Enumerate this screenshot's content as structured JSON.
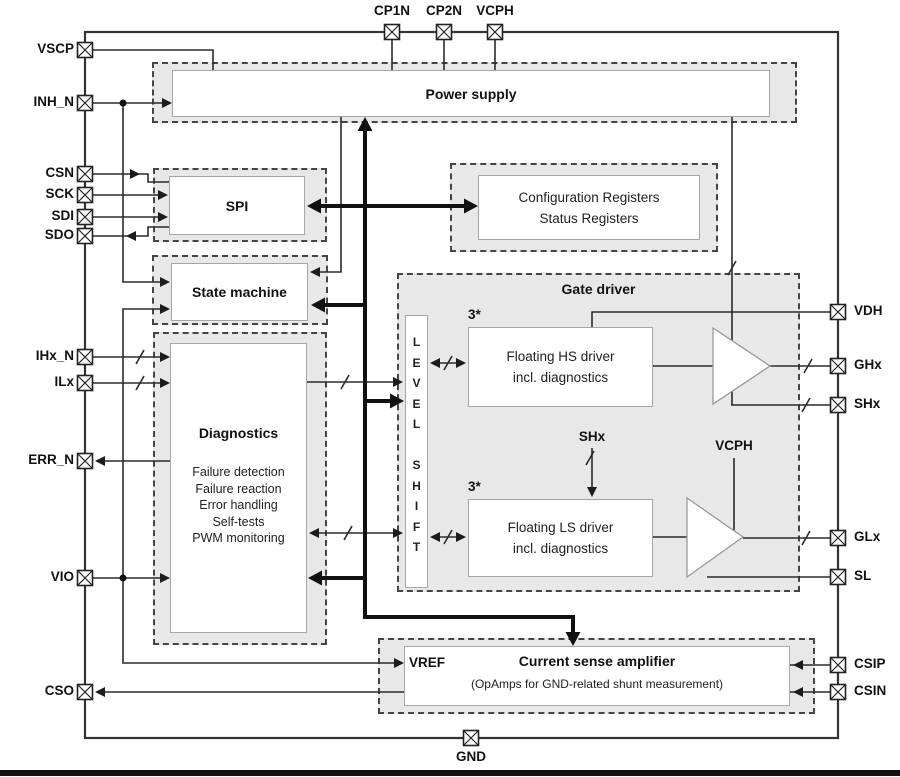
{
  "pins": {
    "vscp": "VSCP",
    "inh_n": "INH_N",
    "csn": "CSN",
    "sck": "SCK",
    "sdi": "SDI",
    "sdo": "SDO",
    "ihx_n": "IHx_N",
    "ilx": "ILx",
    "err_n": "ERR_N",
    "vio": "VIO",
    "cso": "CSO",
    "cp1n": "CP1N",
    "cp2n": "CP2N",
    "vcph": "VCPH",
    "vdh": "VDH",
    "ghx": "GHx",
    "shx": "SHx",
    "glx": "GLx",
    "sl": "SL",
    "csip": "CSIP",
    "csin": "CSIN",
    "gnd": "GND"
  },
  "blocks": {
    "power_supply": "Power supply",
    "spi": "SPI",
    "config_registers": "Configuration Registers\nStatus Registers",
    "state_machine": "State machine",
    "diagnostics_title": "Diagnostics",
    "diagnostics_items": "Failure detection\nFailure reaction\nError handling\nSelf-tests\nPWM monitoring",
    "gate_driver": "Gate driver",
    "level_shift": "L\nE\nV\nE\nL\n\nS\nH\nI\nF\nT",
    "hs_count": "3*",
    "hs_driver": "Floating HS driver\nincl. diagnostics",
    "ls_count": "3*",
    "ls_driver": "Floating LS driver\nincl. diagnostics",
    "shx_internal": "SHx",
    "vcph_internal": "VCPH",
    "csa_vref": "VREF",
    "csa_title": "Current sense amplifier",
    "csa_subtitle": "(OpAmps for GND-related shunt measurement)"
  },
  "colors": {
    "block_fill": "#e8e8e8",
    "wire": "#2b2b2b",
    "bus": "#111111",
    "dash_border": "#454545"
  }
}
